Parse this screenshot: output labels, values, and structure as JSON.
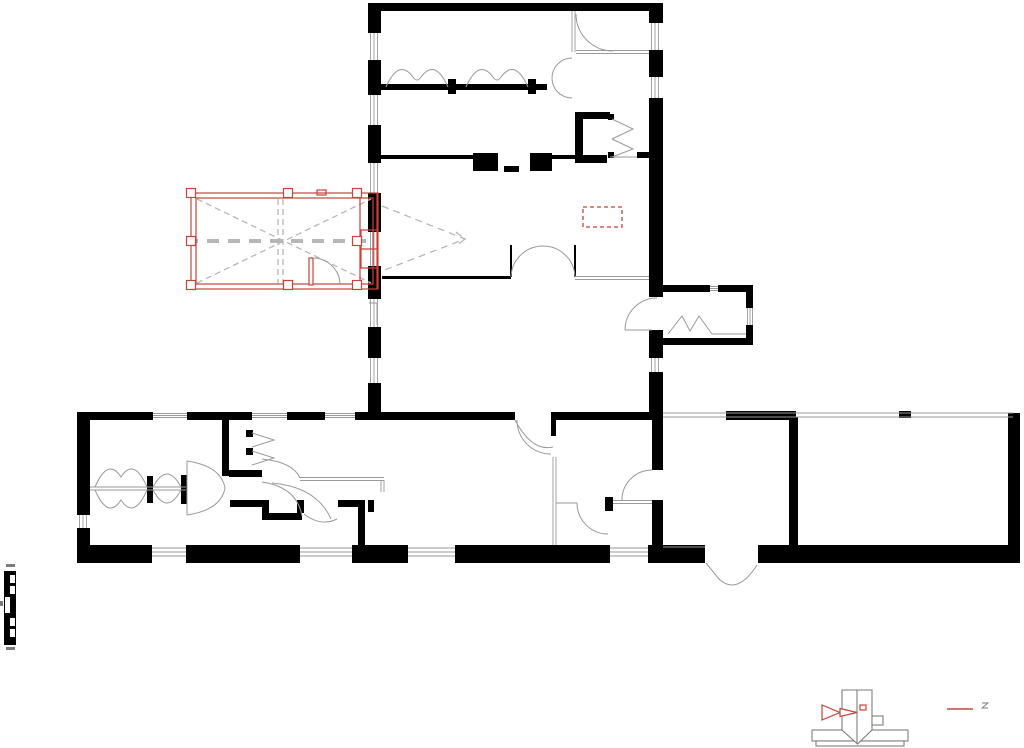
{
  "document": {
    "kind": "architectural floor plan drawing",
    "page_background": "#ffffff",
    "canvas": {
      "width": 1024,
      "height": 748
    }
  },
  "palette": {
    "wall": "#000000",
    "thin": "#9a9a9a",
    "dashed": "#b7b7b7",
    "accent": "#c8423a",
    "detail": "#7d7d7d",
    "paper": "#ffffff"
  },
  "components": [
    {
      "name": "north-wing-plan"
    },
    {
      "name": "south-wing-plan"
    },
    {
      "name": "east-garage-extension"
    },
    {
      "name": "east-vestibule"
    },
    {
      "name": "annex-room-red-highlight"
    },
    {
      "name": "red-dashed-marker-box"
    },
    {
      "name": "view-cone-dashed"
    },
    {
      "name": "graphic-scale-bar"
    },
    {
      "name": "plinth-detail-figure"
    },
    {
      "name": "red-leader-line"
    }
  ]
}
